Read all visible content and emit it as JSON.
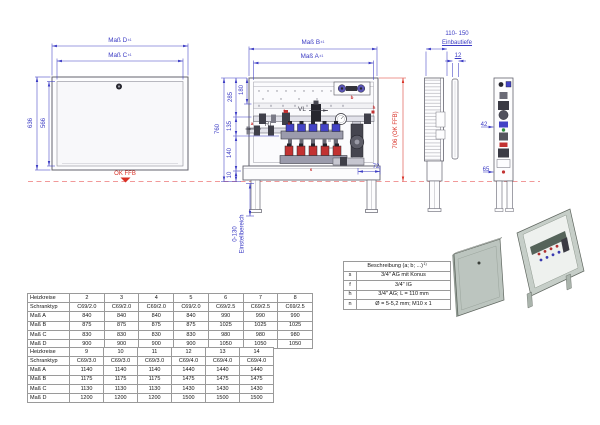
{
  "colors": {
    "dimension_blue": "#3b3bc4",
    "accent_red": "#d93025",
    "floor_dash_red": "#f19999",
    "line_gray": "#63636e",
    "manifold_blue": "#4343c6",
    "manifold_red": "#c23232",
    "iso_panel_green_gray": "#bcc5bf"
  },
  "front_view_closed": {
    "dim_width_outer": {
      "label": "Maß D",
      "tol": "±1"
    },
    "dim_width_inner": {
      "label": "Maß C",
      "tol": "±1"
    },
    "dim_height_outer": "636",
    "dim_height_inner": "566",
    "floor_label": "OK FFB"
  },
  "front_view_open": {
    "dim_width_outer": {
      "label": "Maß B",
      "tol": "±1"
    },
    "dim_width_inner": {
      "label": "Maß A",
      "tol": "±1"
    },
    "dim_total_height": "760",
    "dim_top_to_supply": "285",
    "dim_top_to_rail": "180",
    "dim_supply_to_manifold": "135",
    "dim_manifold_to_base": "140",
    "dim_base": "10",
    "dim_base_offset": "72",
    "dim_height_over_floor": "706 (OK FFB)",
    "supply_label": "VL",
    "return_label": "RL",
    "adjust_range": "0-130",
    "adjust_label": "Einstellbereich",
    "part_letters": [
      "f",
      "n",
      "a",
      "b",
      "h",
      "s"
    ]
  },
  "side_views": {
    "depth_range": "110- 150",
    "depth_label": "Einbautiefe",
    "dim_door_thickness": "12",
    "dim_42": "42",
    "dim_65": "65"
  },
  "legend": {
    "header": "Beschreibung (a; b; ...)",
    "header_note": "1)",
    "rows": [
      {
        "key": "s",
        "value": "3/4\" AG mit Konus"
      },
      {
        "key": "f",
        "value": "3/4\" IG"
      },
      {
        "key": "h",
        "value": "3/4\" AG; L = 110 mm"
      },
      {
        "key": "n",
        "value": "Ø = 5-5,2 mm; M10 x 1"
      }
    ]
  },
  "size_tables": {
    "table1": {
      "rows": [
        [
          "Heizkreise",
          "2",
          "3",
          "4",
          "5",
          "6",
          "7",
          "8"
        ],
        [
          "Schranktyp",
          "C69/2.0",
          "C69/2.0",
          "C69/2.0",
          "C69/2.0",
          "C69/2.5",
          "C69/2.5",
          "C69/2.5"
        ],
        [
          "Maß A",
          "840",
          "840",
          "840",
          "840",
          "990",
          "990",
          "990"
        ],
        [
          "Maß B",
          "875",
          "875",
          "875",
          "875",
          "1025",
          "1025",
          "1025"
        ],
        [
          "Maß C",
          "830",
          "830",
          "830",
          "830",
          "980",
          "980",
          "980"
        ],
        [
          "Maß D",
          "900",
          "900",
          "900",
          "900",
          "1050",
          "1050",
          "1050"
        ]
      ]
    },
    "table2": {
      "rows": [
        [
          "Heizkreise",
          "9",
          "10",
          "11",
          "12",
          "13",
          "14"
        ],
        [
          "Schranktyp",
          "C69/3.0",
          "C69/3.0",
          "C69/3.0",
          "C69/4.0",
          "C69/4.0",
          "C69/4.0"
        ],
        [
          "Maß A",
          "1140",
          "1140",
          "1140",
          "1440",
          "1440",
          "1440"
        ],
        [
          "Maß B",
          "1175",
          "1175",
          "1175",
          "1475",
          "1475",
          "1475"
        ],
        [
          "Maß C",
          "1130",
          "1130",
          "1130",
          "1430",
          "1430",
          "1430"
        ],
        [
          "Maß D",
          "1200",
          "1200",
          "1200",
          "1500",
          "1500",
          "1500"
        ]
      ]
    }
  }
}
